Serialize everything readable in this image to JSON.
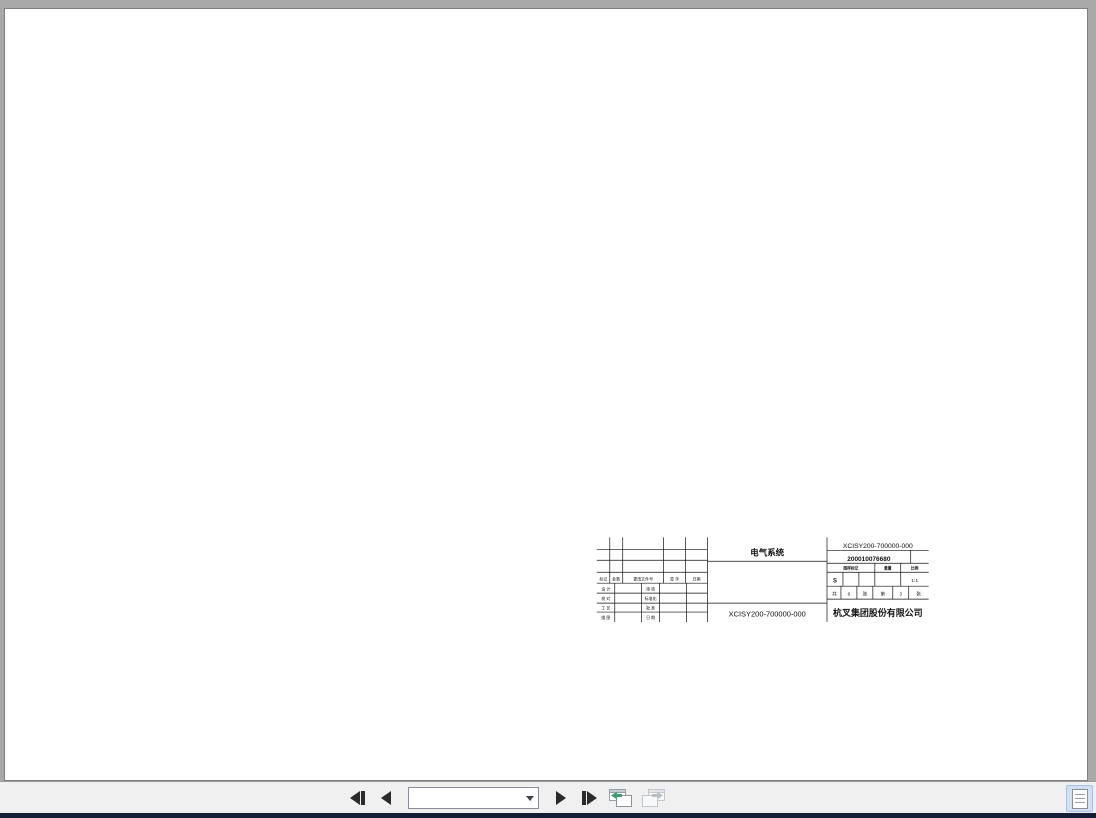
{
  "viewer": {
    "toolbar": {
      "page_field": "197 / 201",
      "first_page": "first page",
      "prev_page": "previous page",
      "next_page": "next page",
      "last_page": "last page",
      "prev_view_color": "#3f9d6e",
      "disabled_color": "#c3c6cc"
    }
  },
  "document": {
    "caption": "CPDS20-XCY2B-SI Electrical system principle diagram （3）",
    "page_number": "193",
    "title_block": {
      "rect": [
        445,
        463,
        333,
        85
      ],
      "vlines": [
        [
          556,
          463,
          548
        ],
        [
          676,
          463,
          548
        ],
        [
          458,
          463,
          509
        ],
        [
          471,
          463,
          509
        ],
        [
          512,
          463,
          509
        ],
        [
          534,
          463,
          509
        ],
        [
          463,
          509,
          548
        ],
        [
          490,
          509,
          548
        ],
        [
          508,
          509,
          548
        ],
        [
          535,
          509,
          548
        ],
        [
          760,
          476,
          489
        ],
        [
          724,
          489,
          498
        ],
        [
          750,
          489,
          498
        ],
        [
          692,
          498,
          512
        ],
        [
          708,
          498,
          512
        ],
        [
          724,
          498,
          512
        ],
        [
          750,
          498,
          512
        ],
        [
          690,
          512,
          525
        ],
        [
          706,
          512,
          525
        ],
        [
          722,
          512,
          525
        ],
        [
          742,
          512,
          525
        ],
        [
          758,
          512,
          525
        ]
      ],
      "hlines": [
        [
          475,
          445,
          556
        ],
        [
          486,
          445,
          556
        ],
        [
          498,
          445,
          556
        ],
        [
          509,
          445,
          556
        ],
        [
          519,
          445,
          556
        ],
        [
          529,
          445,
          556
        ],
        [
          538,
          445,
          556
        ],
        [
          487,
          556,
          676
        ],
        [
          529,
          556,
          676
        ],
        [
          476,
          676,
          778
        ],
        [
          489,
          676,
          778
        ],
        [
          498,
          676,
          778
        ],
        [
          512,
          676,
          778
        ],
        [
          525,
          676,
          778
        ]
      ],
      "texts": [
        [
          451.5,
          506.5,
          "标记",
          4,
          0
        ],
        [
          464.5,
          506.5,
          "处数",
          4,
          0
        ],
        [
          491.5,
          506.5,
          "更改文件号",
          4,
          0
        ],
        [
          523,
          506.5,
          "签 字",
          4,
          0
        ],
        [
          545,
          506.5,
          "日期",
          4,
          0
        ],
        [
          454,
          516.5,
          "设 计",
          4,
          0
        ],
        [
          499,
          516.5,
          "审 核",
          4,
          0
        ],
        [
          454,
          526,
          "校 对",
          4,
          0
        ],
        [
          499,
          526,
          "标准化",
          4,
          0
        ],
        [
          454,
          535.5,
          "工 艺",
          4,
          0
        ],
        [
          499,
          535.5,
          "批 准",
          4,
          0
        ],
        [
          454,
          545,
          "描 图",
          4,
          0
        ],
        [
          499,
          545,
          "日 期",
          4,
          0
        ],
        [
          616,
          481,
          "电气系统",
          8.5,
          1
        ],
        [
          616,
          542.5,
          "XCISY200-700000-000",
          7.5,
          0
        ],
        [
          727,
          473.5,
          "XCISY200-700000-000",
          6.8,
          0
        ],
        [
          718,
          486.5,
          "200010076680",
          6.5,
          1
        ],
        [
          700,
          495.5,
          "图样标记",
          3.8,
          1
        ],
        [
          737,
          495.5,
          "重量",
          3.8,
          1
        ],
        [
          764,
          495.5,
          "比例",
          3.8,
          1
        ],
        [
          684,
          508.5,
          "S",
          6,
          1
        ],
        [
          764,
          508,
          "1:1",
          5,
          0
        ],
        [
          683.5,
          521.5,
          "共",
          4.6,
          0
        ],
        [
          698,
          521.5,
          "6",
          4.6,
          0
        ],
        [
          714,
          521.5,
          "张",
          4.6,
          0
        ],
        [
          732,
          521.5,
          "第",
          4.6,
          0
        ],
        [
          750,
          521.5,
          "3",
          4.6,
          0
        ],
        [
          768,
          521.5,
          "张",
          4.6,
          0
        ],
        [
          727,
          542,
          "杭叉集团股份有限公司",
          9,
          1
        ]
      ]
    }
  },
  "schematic": {
    "sheet_ref": "XCISY200-700000-000",
    "controller_title": "Pump Controller",
    "zone_cols": [
      "1",
      "2",
      "3",
      "4",
      "5",
      "6",
      "7",
      "8",
      "9",
      "10",
      "11",
      "12"
    ],
    "zone_rows": [
      "A",
      "B",
      "C",
      "D",
      "E",
      "F",
      "G",
      "H"
    ],
    "buses": [
      {
        "label": "B+/501",
        "y": 42,
        "x2": 206
      },
      {
        "label": "CAN_H/A",
        "y": 56,
        "x2": 386
      },
      {
        "label": "CAN_L/B",
        "y": 70,
        "x2": 398
      },
      {
        "label": "F4/005",
        "y": 84,
        "x2": 130
      },
      {
        "label": "F3/010",
        "y": 98,
        "x2": 424
      }
    ],
    "top_terminals": [
      {
        "x": 106,
        "t": "B+"
      },
      {
        "x": 130,
        "t": "KSI"
      },
      {
        "x": 152,
        "t": "DIN1"
      },
      {
        "x": 174,
        "t": "EN",
        "b": 1
      },
      {
        "x": 196,
        "t": "Sfw1",
        "b": 1
      },
      {
        "x": 228,
        "t": "Sfw2",
        "b": 1
      },
      {
        "x": 276,
        "t": "Sfw5",
        "b": 1
      },
      {
        "x": 300,
        "t": "DIN2"
      },
      {
        "x": 318,
        "t": "DIN3"
      },
      {
        "x": 336,
        "t": "DIN4"
      },
      {
        "x": 354,
        "t": "DIN5"
      },
      {
        "x": 386,
        "t": "CAN_H",
        "b": 1
      },
      {
        "x": 398,
        "t": "CAN_L",
        "b": 1
      },
      {
        "x": 424,
        "t": "OUT",
        "b": 1
      }
    ],
    "top_wires": [
      {
        "x": 106,
        "top": 122,
        "pin": "X66:1"
      },
      {
        "x": 130,
        "top": 84,
        "g": "015(0.50)",
        "pin": "X66:11"
      },
      {
        "x": 152,
        "top": 98,
        "g": "056(2.00)",
        "pin": "X66:13"
      },
      {
        "x": 174,
        "top": 98,
        "g": "059(0.50)",
        "pin": "X66:3"
      },
      {
        "x": 196,
        "top": 189,
        "g": "050(0.50)",
        "pin": "X66:6",
        "p2": "X30/13"
      },
      {
        "x": 228,
        "top": 189,
        "g": "053(0.50)",
        "pin": "X66:16",
        "p2": "X30/12"
      },
      {
        "x": 276,
        "top": 189,
        "g": "054(0.50)",
        "pin": "X66:4",
        "p2": "X60:1"
      },
      {
        "x": 300,
        "top": 178,
        "g": "020(0.50)",
        "pin": "X66:28",
        "p2": "54TA/2"
      },
      {
        "x": 318,
        "top": 178,
        "g": "021(0.50)",
        "pin": "X66:9",
        "p2": "54TB/2"
      },
      {
        "x": 336,
        "top": 178,
        "g": "022(0.50)",
        "pin": "X66:10",
        "p2": "54TC/2"
      },
      {
        "x": 354,
        "top": 186,
        "g": "007(0.50)",
        "pin": "X66:12",
        "p2": "X11B/4"
      },
      {
        "x": 386,
        "top": 56,
        "g": "1A(0.50)",
        "pin": "X66:25",
        "can": 1
      },
      {
        "x": 398,
        "top": 70,
        "g": "1B(0.50)",
        "pin": "X66:35",
        "can": 1
      },
      {
        "x": 424,
        "top": 225,
        "g": "056(0.50)",
        "pin": "X66:26"
      }
    ],
    "coils": [
      {
        "x": 196,
        "t": "K3",
        "top_pin": "X30/A1"
      },
      {
        "x": 228,
        "t": "K8",
        "top_pin": "X30/A2"
      },
      {
        "x": 276,
        "t": "KM5",
        "top_pin": "X60:2"
      }
    ],
    "switch_tops": [
      {
        "x": 300,
        "pin": "54TA/1",
        "g": "015(0.50)"
      },
      {
        "x": 318,
        "pin": "54TB/1",
        "g": "015(0.50)"
      },
      {
        "x": 336,
        "pin": "54TC/1",
        "g": "015(0.50)"
      }
    ],
    "rects": [
      [
        118,
        153,
        565,
        102
      ],
      [
        185,
        103,
        223,
        154
      ]
    ],
    "lines": [
      [
        196,
        113,
        276,
        113
      ],
      [
        206,
        42,
        206,
        113
      ],
      [
        196,
        113,
        196,
        168
      ],
      [
        228,
        113,
        228,
        168
      ],
      [
        276,
        113,
        276,
        168
      ],
      [
        196,
        177,
        196,
        189
      ],
      [
        228,
        177,
        228,
        189
      ],
      [
        276,
        177,
        276,
        189
      ],
      [
        294,
        98,
        294,
        108
      ],
      [
        294,
        108,
        336,
        108
      ],
      [
        300,
        108,
        300,
        160
      ],
      [
        318,
        108,
        318,
        160
      ],
      [
        336,
        108,
        336,
        160
      ],
      [
        300,
        162,
        294,
        176
      ],
      [
        318,
        162,
        312,
        176
      ],
      [
        336,
        162,
        330,
        176
      ],
      [
        326,
        98,
        326,
        173
      ],
      [
        326,
        173,
        336,
        173
      ],
      [
        424,
        98,
        424,
        205
      ],
      [
        424,
        207,
        418,
        221
      ],
      [
        424,
        223,
        424,
        226
      ],
      [
        106,
        120,
        106,
        150
      ],
      [
        106,
        156,
        99,
        172
      ],
      [
        106,
        174,
        106,
        197
      ],
      [
        106,
        221,
        106,
        273
      ],
      [
        143,
        222,
        143,
        162
      ],
      [
        212,
        150,
        212,
        122
      ],
      [
        252,
        150,
        252,
        122
      ],
      [
        368,
        160,
        368,
        130
      ],
      [
        368,
        186,
        368,
        228
      ],
      [
        341.5,
        173,
        336,
        173
      ],
      [
        352.5,
        173,
        368,
        173
      ],
      [
        354,
        173,
        354,
        186
      ],
      [
        368,
        173,
        368,
        186
      ],
      [
        106,
        457,
        663,
        457
      ],
      [
        388,
        375,
        408,
        375
      ],
      [
        388,
        375,
        388,
        403
      ],
      [
        408,
        375,
        408,
        403
      ],
      [
        344,
        403,
        344,
        424
      ],
      [
        364,
        403,
        364,
        424
      ],
      [
        354,
        403,
        354,
        419
      ],
      [
        398,
        420,
        398,
        419
      ],
      [
        389,
        375,
        389,
        375
      ]
    ],
    "dots": [
      [
        106,
        240
      ],
      [
        106,
        457
      ],
      [
        152,
        98
      ],
      [
        174,
        98
      ],
      [
        294,
        98
      ],
      [
        326,
        98
      ],
      [
        228,
        113
      ],
      [
        398,
        375
      ],
      [
        354,
        173
      ]
    ],
    "tips": [
      [
        106,
        119,
        "u"
      ],
      [
        143,
        161,
        "u"
      ],
      [
        212,
        121,
        "u"
      ],
      [
        252,
        121,
        "u"
      ],
      [
        368,
        129,
        "u"
      ],
      [
        368,
        229,
        "d"
      ],
      [
        663,
        457,
        "r"
      ],
      [
        354,
        420,
        "d"
      ],
      [
        398,
        420,
        "d"
      ]
    ],
    "labels_h": [
      [
        100.5,
        117,
        "B+",
        "e"
      ],
      [
        92,
        163,
        "KM0",
        "e"
      ],
      [
        96,
        205,
        "FU1",
        "e"
      ],
      [
        96,
        213,
        "300A",
        "e"
      ],
      [
        100,
        340,
        "B-",
        "e"
      ],
      [
        101,
        459.5,
        "B-49",
        "e"
      ],
      [
        668,
        459.5,
        "B-49",
        "s"
      ],
      [
        293,
        171,
        "S9",
        "e"
      ],
      [
        311,
        171,
        "S10",
        "e"
      ],
      [
        329,
        171,
        "S11",
        "e"
      ],
      [
        337,
        157,
        "E7",
        "s"
      ],
      [
        168,
        407.5,
        "U3",
        "s"
      ],
      [
        335,
        400.5,
        "R1",
        "s"
      ],
      [
        381,
        400.5,
        "R2",
        "s"
      ]
    ],
    "labels_rot": [
      [
        141.5,
        166,
        "009(0.85)",
        "e"
      ],
      [
        102,
        190,
        "(50)",
        "m"
      ],
      [
        104,
        392,
        "(50)",
        "m"
      ],
      [
        366.5,
        140,
        "X11B/3",
        "e"
      ],
      [
        366.5,
        100,
        "24V+OFF",
        "e"
      ],
      [
        366.5,
        192,
        "X11B/5",
        "e"
      ],
      [
        366.5,
        212,
        "GND0",
        "e"
      ]
    ],
    "e7_box": [
      336,
      160,
      40,
      26
    ],
    "fuse_box": [
      100,
      197,
      12,
      24
    ],
    "bottom_terminals": [
      {
        "x": 106,
        "t": "B-"
      },
      {
        "x": 148,
        "t": "U"
      },
      {
        "x": 161,
        "t": "V"
      },
      {
        "x": 174,
        "t": "W"
      },
      {
        "x": 196,
        "t": "TEMP+",
        "b": 1
      },
      {
        "x": 212,
        "t": "TEMP-",
        "b": 1
      },
      {
        "x": 233,
        "t": "5V+",
        "b": 1
      },
      {
        "x": 245,
        "t": "D0",
        "b": 1
      },
      {
        "x": 257,
        "t": "D1",
        "b": 1
      },
      {
        "x": 269,
        "t": "D2",
        "b": 1
      },
      {
        "x": 281,
        "t": "D3",
        "b": 1
      },
      {
        "x": 293,
        "t": "D4",
        "b": 1
      },
      {
        "x": 344,
        "t": "5V+",
        "b": 1
      },
      {
        "x": 354,
        "t": "AIN2",
        "b": 1
      },
      {
        "x": 364,
        "t": "5V-",
        "b": 1
      },
      {
        "x": 398,
        "t": "AIN1"
      }
    ],
    "bottom_wires": [
      {
        "x": 106,
        "end": 457,
        "g": "(50)"
      },
      {
        "x": 148,
        "end": 410,
        "p1": "U3",
        "g": "(50)",
        "p2": "M3 U3"
      },
      {
        "x": 161,
        "end": 410,
        "p1": "V3",
        "g": "(50)",
        "p2": "M3 V3"
      },
      {
        "x": 174,
        "end": 410,
        "p1": "W3",
        "g": "(50)",
        "p2": "M3 W3"
      },
      {
        "x": 196,
        "end": 413,
        "p1": "X56:17",
        "g": "047(0.50)",
        "p2": "M3:7"
      },
      {
        "x": 212,
        "end": 413,
        "p1": "X56:18",
        "g": "048(0.50)",
        "p2": "M3:8"
      },
      {
        "x": 233,
        "end": 420,
        "p1": "X56:27",
        "g": "041(0.50)",
        "p2": "M3:5"
      },
      {
        "x": 245,
        "end": 420,
        "p1": "X56:28",
        "g": "043(0.50)",
        "p2": "M3:6"
      },
      {
        "x": 257,
        "end": 420,
        "p1": "X56:29",
        "g": "044(0.50)",
        "p2": "M3:3"
      },
      {
        "x": 269,
        "end": 420,
        "p1": "X56:30",
        "g": "045(0.50)",
        "p2": "M3:4"
      },
      {
        "x": 281,
        "end": 420,
        "p1": "X56:31",
        "g": "046(0.50)",
        "p2": "M3:1"
      },
      {
        "x": 293,
        "end": 420,
        "p1": "X56:32",
        "g": "040(0.50)",
        "p2": "M3:2"
      },
      {
        "x": 344,
        "end": 403,
        "p1": "X56:15",
        "g": "049(0.50)",
        "p2": "R0:2"
      },
      {
        "x": 354,
        "end": 403,
        "p1": "X56:17",
        "g": "051(0.50)",
        "p2": "R0:1"
      },
      {
        "x": 364,
        "end": 403,
        "p1": "X56:19",
        "g": "050(0.50)",
        "p2": "R0:3"
      },
      {
        "x": 398,
        "end": 403,
        "p1": "X56:16",
        "g": "006(0.50)",
        "p2": "X11B:2"
      }
    ],
    "r2_pins": [
      [
        387,
        378,
        "X11B:1"
      ],
      [
        407,
        378,
        "X11B:3"
      ]
    ],
    "motor": {
      "cx": 161,
      "cy": 423,
      "r": 13,
      "t1": "M3",
      "t2": "3~"
    },
    "u3_box": {
      "x": 166,
      "y": 410,
      "w": 130,
      "h": 32
    },
    "temp_box": {
      "x": 190,
      "y": 413,
      "w": 34,
      "h": 12,
      "t": "TEMP"
    },
    "coder_box": {
      "x": 232,
      "y": 420,
      "w": 58,
      "h": 16,
      "t": "CODER"
    },
    "r1_box": [
      334,
      403,
      38,
      30
    ],
    "r2_box": [
      380,
      403,
      36,
      30
    ],
    "resistors": [
      [
        196,
        429,
        14,
        4
      ],
      [
        345,
        424,
        18,
        5
      ],
      [
        389,
        424,
        18,
        5
      ]
    ]
  }
}
